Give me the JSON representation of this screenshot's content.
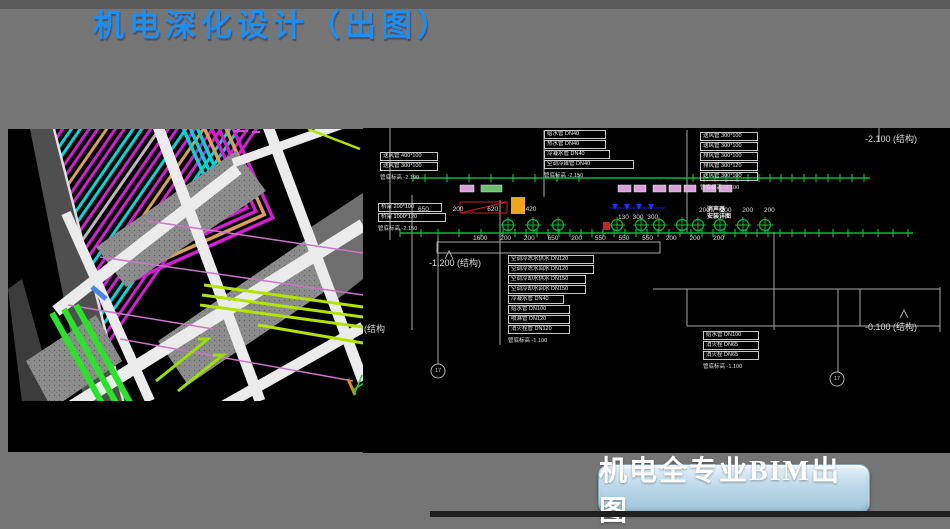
{
  "slide": {
    "title": "机电深化设计（出图）",
    "badge": "机电全专业BIM出图"
  },
  "palette": {
    "title_blue": "#1d8ff0",
    "cad_green": "#00bb3c",
    "pipe_magenta": "#d020d0",
    "pipe_cyan": "#00d8d8",
    "pipe_chartreuse": "#b4e300",
    "badge_blue": "#bcd9e9"
  },
  "cad": {
    "elevation_top_right": "-2.100 (结构)",
    "elevation_mid": "-1.200 (结构)",
    "elevation_bottom_right": "-0.100 (结构)",
    "elevation_left_partial": "(结构",
    "note_line1": "消声器",
    "note_line2": "安装详图",
    "bubble_left": "17",
    "bubble_right": "17",
    "dims": {
      "upper_left": "650 200 620 1420",
      "upper_mid": "130 300 300",
      "upper_right": "200 200 200 200",
      "lower": "1600 200 200 650 200 550 550 550 200 200 200"
    },
    "ladders": {
      "a": {
        "rows": [
          "送风管 400*100",
          "送风管 300*100"
        ],
        "footer": "管底标高 -2.100"
      },
      "b": {
        "rows": [
          "桥架 200*100",
          "桥架 1000*120"
        ],
        "footer": "管底标高 -2.150"
      },
      "c": {
        "rows": [
          "给水管 DN40",
          "热水管 DN40",
          "冷凝水管 DN40",
          "空调冷媒管 DN40"
        ],
        "footer": "管底标高 -2.150"
      },
      "d": {
        "rows": [
          "送风管 300*100",
          "送风管 300*100",
          "排风管 300*100",
          "排风管 300*120",
          "送风管 300*100"
        ],
        "footer": "管底标高 -2.100"
      },
      "e": {
        "rows": [
          "空调冷冻水供水 DN120",
          "空调冷冻水回水 DN120",
          "空调冷却水供水 DN150",
          "空调冷却水回水 DN150",
          "冷凝水管 DN40",
          "给水管 DN100",
          "喷淋管 DN120",
          "消火栓管 DN120"
        ],
        "footer": "管底标高 -1.100"
      },
      "f": {
        "rows": [
          "给水管 DN100",
          "消火栓 DN65",
          "消火栓 DN65"
        ],
        "footer": "管底标高 -1.100"
      }
    }
  }
}
